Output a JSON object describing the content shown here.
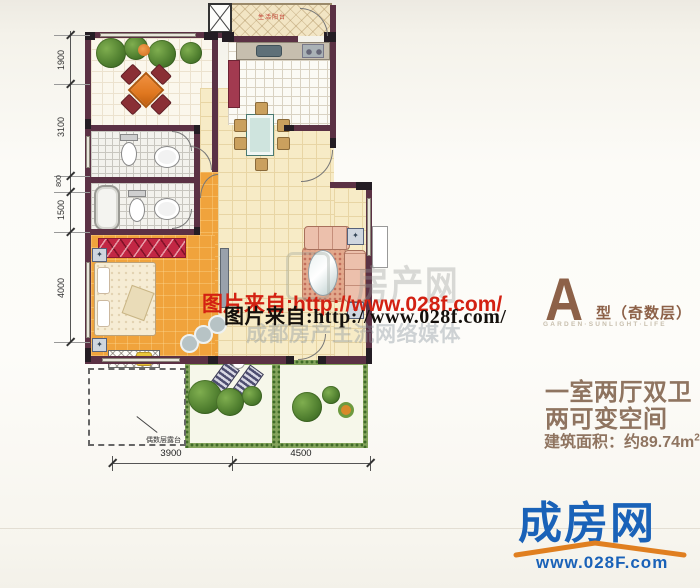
{
  "dimensions": {
    "left": [
      "1900",
      "3100",
      "800",
      "1500",
      "4000"
    ],
    "bottom": [
      "3900",
      "4500"
    ]
  },
  "plan_labels": {
    "service_balcony": "生活阳台",
    "even_floor_terrace": "偶数层露台"
  },
  "watermarks": {
    "red_url": "图片来自:http://www.028f.com/",
    "black_url": "图片来自:http://www.028f.com/",
    "brand_faint": "房产网",
    "slogan_faint": "成都房产主流网络媒体"
  },
  "unit_info": {
    "type_letter": "A",
    "type_label": "型（奇数层）",
    "tagline": "GARDEN·SUNLIGHT·LIFE",
    "feature_line1": "一室两厅双卫",
    "feature_line2": "两可变空间",
    "area_text": "建筑面积：约89.74m",
    "area_superscript": "2"
  },
  "site_logo": {
    "brand": "成房网",
    "url": "www.028F.com"
  },
  "colors": {
    "wall": "#5b3144",
    "bedroom_floor": "#f0a33c",
    "living_floor": "#f7ebc6",
    "accent_red": "#c22744",
    "brand_blue": "#1a62b8",
    "brand_orange": "#e07f20",
    "info_brown": "#8f7460",
    "watermark_red": "#d32112"
  }
}
